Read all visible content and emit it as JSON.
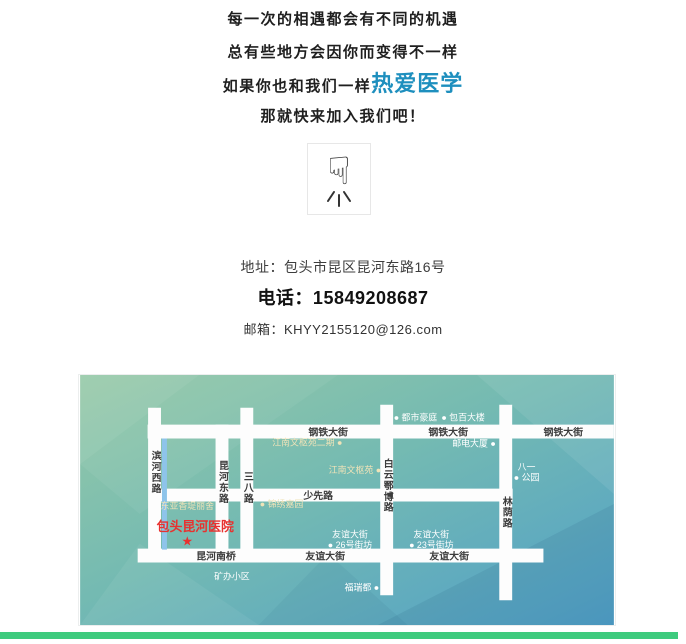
{
  "intro": {
    "line1": "每一次的相遇都会有不同的机遇",
    "line2": "总有些地方会因你而变得不一样",
    "line3_prefix": "如果你也和我们一样",
    "line3_highlight": "热爱医学",
    "line4": "那就快来加入我们吧！"
  },
  "hand_icon": "pointing-down-hand",
  "contact": {
    "address": "地址：包头市昆区昆河东路16号",
    "phone": "电话：15849208687",
    "email": "邮箱：KHYY2155120@126.com"
  },
  "colors": {
    "highlight_blue": "#1e8fbe",
    "accent_green_bar": "#3ecb7e",
    "hospital_red": "#e8312f",
    "map_green": "#96c9a7",
    "map_blue": "#51a0c8",
    "river_blue": "#8ec4ea",
    "road_white": "#fdfdfd"
  },
  "map": {
    "roads": [
      {
        "id": "gangtie-dajie",
        "x1": 68,
        "y1": 57,
        "x2": 538,
        "y2": 57,
        "w": 14
      },
      {
        "id": "shaoxian-lu",
        "x1": 75,
        "y1": 121,
        "x2": 436,
        "y2": 121,
        "w": 13
      },
      {
        "id": "youyi-dajie",
        "x1": 58,
        "y1": 182,
        "x2": 467,
        "y2": 182,
        "w": 14
      },
      {
        "id": "binhe-xilu",
        "x1": 75,
        "y1": 33,
        "x2": 75,
        "y2": 189,
        "w": 13
      },
      {
        "id": "kunhe-donglu",
        "x1": 143,
        "y1": 50,
        "x2": 143,
        "y2": 189,
        "w": 13
      },
      {
        "id": "sanba-lu",
        "x1": 168,
        "y1": 33,
        "x2": 168,
        "y2": 189,
        "w": 13
      },
      {
        "id": "baiyun-ebo-lu",
        "x1": 309,
        "y1": 30,
        "x2": 309,
        "y2": 222,
        "w": 13
      },
      {
        "id": "linyin-lu",
        "x1": 429,
        "y1": 30,
        "x2": 429,
        "y2": 227,
        "w": 13
      },
      {
        "id": "river",
        "x1": 85,
        "y1": 64,
        "x2": 85,
        "y2": 176,
        "w": 5,
        "color": "#8ec4ea"
      }
    ],
    "labels": [
      {
        "id": "street-gangtie-1",
        "text": "钢铁大街",
        "x": 250,
        "y": 61,
        "color": "#3c3c3c",
        "size": 10,
        "bold": true
      },
      {
        "id": "street-gangtie-2",
        "text": "钢铁大街",
        "x": 371,
        "y": 61,
        "color": "#3c3c3c",
        "size": 10,
        "bold": true
      },
      {
        "id": "street-gangtie-3",
        "text": "钢铁大街",
        "x": 487,
        "y": 61,
        "color": "#3c3c3c",
        "size": 10,
        "bold": true
      },
      {
        "id": "street-shaoxian",
        "text": "少先路",
        "x": 240,
        "y": 125,
        "color": "#3c3c3c",
        "size": 10,
        "bold": true
      },
      {
        "id": "street-kunhe-nanqiao",
        "text": "昆河南桥",
        "x": 137,
        "y": 186,
        "color": "#3c3c3c",
        "size": 10,
        "bold": true
      },
      {
        "id": "street-youyi-1",
        "text": "友谊大街",
        "x": 247,
        "y": 186,
        "color": "#3c3c3c",
        "size": 10,
        "bold": true
      },
      {
        "id": "street-youyi-2",
        "text": "友谊大街",
        "x": 372,
        "y": 186,
        "color": "#3c3c3c",
        "size": 10,
        "bold": true
      },
      {
        "id": "street-binhe-xilu",
        "text": "滨河西路",
        "x": 75,
        "y": 76,
        "color": "#3c3c3c",
        "size": 10,
        "bold": true,
        "vertical": true
      },
      {
        "id": "street-kunhe-donglu",
        "text": "昆河东路",
        "x": 143,
        "y": 86,
        "color": "#3c3c3c",
        "size": 10,
        "bold": true,
        "vertical": true
      },
      {
        "id": "street-sanba-lu",
        "text": "三八路",
        "x": 168,
        "y": 97,
        "color": "#3c3c3c",
        "size": 10,
        "bold": true,
        "vertical": true
      },
      {
        "id": "street-baiyun-ebo-lu",
        "text": "白云鄂博路",
        "x": 309,
        "y": 84,
        "color": "#3c3c3c",
        "size": 10,
        "bold": true,
        "vertical": true
      },
      {
        "id": "street-linyin-lu",
        "text": "林荫路",
        "x": 429,
        "y": 122,
        "color": "#3c3c3c",
        "size": 10,
        "bold": true,
        "vertical": true
      },
      {
        "id": "poi-jiangnan-erqi",
        "text": "江南文枢苑二期 ●",
        "x": 229,
        "y": 71,
        "color": "#efe3b8",
        "size": 9
      },
      {
        "id": "poi-jiangnan",
        "text": "江南文枢苑 ●",
        "x": 277,
        "y": 99,
        "color": "#efe3b8",
        "size": 9
      },
      {
        "id": "poi-jinxiu-jiayuan",
        "text": "● 锦绣嘉园",
        "x": 203,
        "y": 133,
        "color": "#efe3b8",
        "size": 9
      },
      {
        "id": "poi-dushi-haoting",
        "text": "● 都市豪庭",
        "x": 338,
        "y": 46,
        "color": "#ffffff",
        "size": 9
      },
      {
        "id": "poi-baobai-dalou",
        "text": "● 包百大楼",
        "x": 386,
        "y": 46,
        "color": "#ffffff",
        "size": 9
      },
      {
        "id": "poi-youdian-dasha",
        "text": "邮电大厦 ●",
        "x": 397,
        "y": 72,
        "color": "#ffffff",
        "size": 9
      },
      {
        "id": "poi-bayi-gongyuan",
        "lines": [
          "八一",
          "● 公园"
        ],
        "x": 450,
        "y": 96,
        "color": "#ffffff",
        "size": 9
      },
      {
        "id": "poi-dongya-xiangdi",
        "text": "东亚香堤丽舍",
        "x": 108,
        "y": 135,
        "color": "#efe3b8",
        "size": 9
      },
      {
        "id": "poi-dongya-dot",
        "text": "●",
        "x": 150,
        "y": 156,
        "color": "#ffffff",
        "size": 9
      },
      {
        "id": "poi-youyi-26",
        "lines": [
          "友谊大街",
          "● 26号街坊"
        ],
        "x": 272,
        "y": 164,
        "color": "#ffffff",
        "size": 9
      },
      {
        "id": "poi-youyi-23",
        "lines": [
          "友谊大街",
          "● 23号街坊"
        ],
        "x": 354,
        "y": 164,
        "color": "#ffffff",
        "size": 9
      },
      {
        "id": "poi-furui-du",
        "text": "福瑞都 ●",
        "x": 284,
        "y": 217,
        "color": "#ffffff",
        "size": 9
      },
      {
        "id": "poi-kuangban-xiaoqu",
        "text": "矿办小区",
        "x": 153,
        "y": 206,
        "color": "#ffffff",
        "size": 9
      },
      {
        "id": "hospital-name",
        "text": "包头昆河医院",
        "x": 116,
        "y": 157,
        "color": "#e8312f",
        "size": 13,
        "bold": true
      },
      {
        "id": "hospital-star",
        "text": "★",
        "x": 108,
        "y": 172,
        "color": "#e8312f",
        "size": 13
      }
    ]
  }
}
